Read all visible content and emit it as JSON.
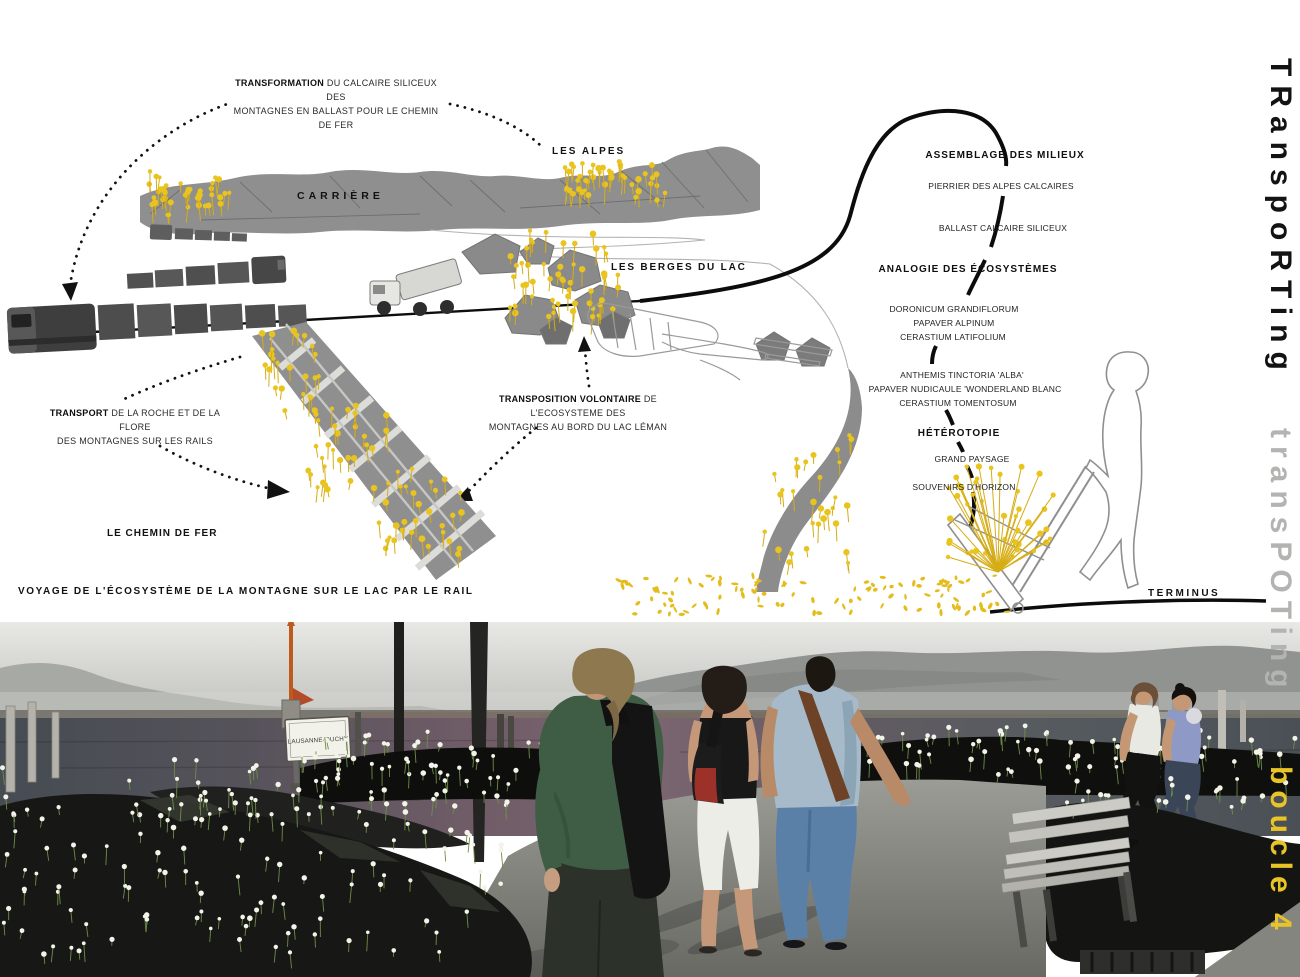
{
  "side_titles": {
    "black": "TRanspoRTing",
    "gray": "transPOTing",
    "yellow": "boucle 4"
  },
  "diagram": {
    "notes": {
      "transformation": {
        "lead": "TRANSFORMATION",
        "rest": " DU CALCAIRE SILICEUX DES",
        "line2": "MONTAGNES EN BALLAST POUR LE CHEMIN DE FER"
      },
      "transport": {
        "lead": "TRANSPORT",
        "rest": " DE LA ROCHE ET DE LA FLORE",
        "line2": "DES MONTAGNES SUR LES RAILS"
      },
      "transposition": {
        "lead": "TRANSPOSITION VOLONTAIRE",
        "rest": " DE L'ECOSYSTEME DES",
        "line2": "MONTAGNES AU BORD DU LAC LÉMAN"
      }
    },
    "labels": {
      "les_alpes": "LES ALPES",
      "carriere": "CARRIÈRE",
      "les_berges": "LES BERGES DU LAC",
      "chemin_de_fer": "LE CHEMIN DE FER",
      "voyage": "VOYAGE DE L'ÉCOSYSTÈME DE LA MONTAGNE SUR LE LAC PAR LE RAIL",
      "terminus": "TERMINUS"
    },
    "sequence": {
      "assemblage": "ASSEMBLAGE DES MILIEUX",
      "pierrier": "PIERRIER DES ALPES CALCAIRES",
      "ballast": "BALLAST CALCAIRE SILICEUX",
      "analogie": "ANALOGIE DES ÉCOSYSTÈMES",
      "sp1a": "DORONICUM GRANDIFLORUM",
      "sp1b": "PAPAVER ALPINUM",
      "sp1c": "CERASTIUM LATIFOLIUM",
      "sp2a": "ANTHEMIS TINCTORIA 'ALBA'",
      "sp2b": "PAPAVER NUDICAULE 'WONDERLAND BLANC",
      "sp2c": "CERASTIUM TOMENTOSUM",
      "heterotopie": "HÉTÉROTOPIE",
      "grand_paysage": "GRAND PAYSAGE",
      "souvenirs": "SOUVENIRS D'HORIZON"
    }
  },
  "photo": {
    "sign_text": "LAUSANNE-OUCHY"
  },
  "colors": {
    "flower_yellow": "#e9c427",
    "diagram_gray": "#8c8c8c",
    "ink": "#141414",
    "title_gray": "#b3b3b1"
  }
}
